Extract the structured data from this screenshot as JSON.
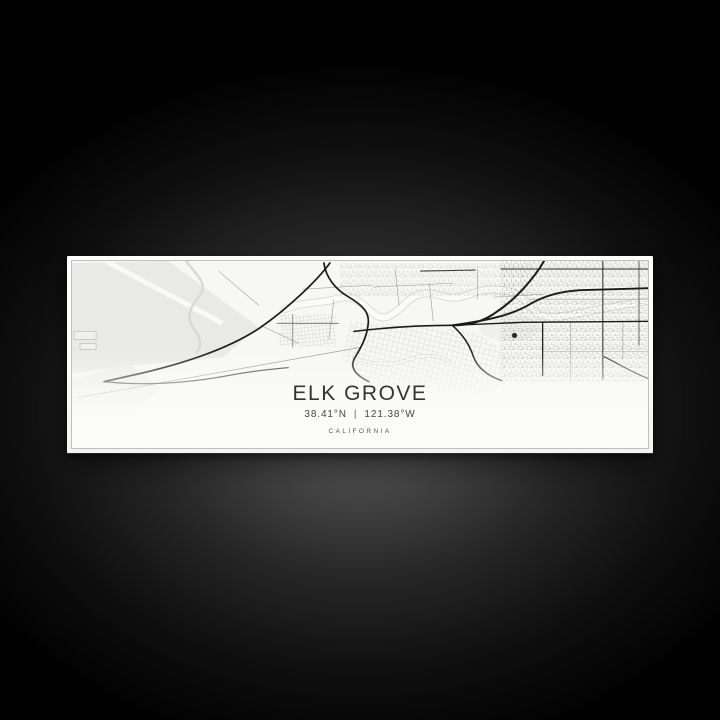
{
  "print": {
    "title": "ELK GROVE",
    "latitude": "38.41°N",
    "separator": "|",
    "longitude": "121.38°W",
    "state": "CALIFORNIA"
  },
  "colors": {
    "backdrop": "#020202",
    "backdrop_glow": "#606060",
    "canvas_white": "#fbfbfa",
    "map_background": "#f7f7f6",
    "map_field": "#e9e9e8",
    "map_creek": "#fbfbfa",
    "map_road_major": "#1b1b1b",
    "map_road_minor": "#9d9d9c",
    "title_text": "#343434",
    "coords_text": "#454545",
    "state_text": "#585858"
  }
}
